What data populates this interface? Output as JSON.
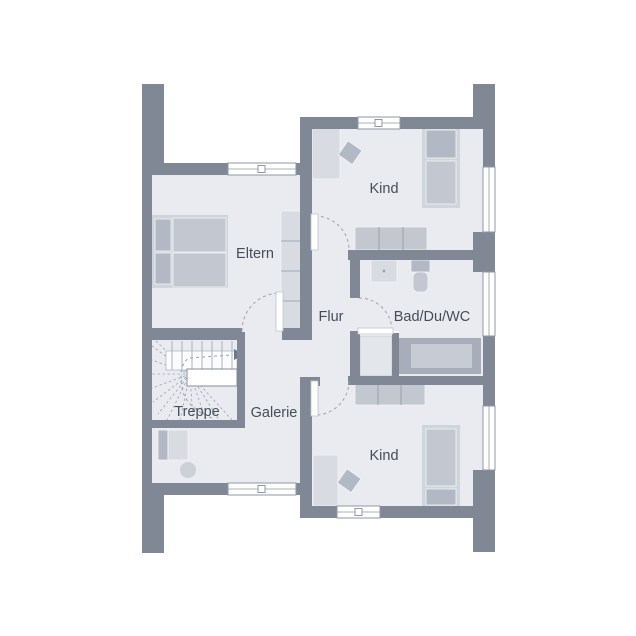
{
  "rooms": {
    "eltern": "Eltern",
    "kind_top": "Kind",
    "bad": "Bad/Du/WC",
    "flur": "Flur",
    "treppe": "Treppe",
    "galerie": "Galerie",
    "kind_bottom": "Kind"
  },
  "colors": {
    "wall": "#808896",
    "floor": "#e9ebf0",
    "background": "#ffffff",
    "furniture_light": "#d8dce2",
    "furniture_mid": "#c2c7d0",
    "furniture_dark": "#b3b9c4",
    "furniture_frame": "#d0d4db",
    "tub_outer": "#a7aeb9",
    "tub_inner": "#c7cbd3",
    "outline": "#9aa3af",
    "window_frame": "#8f97a4",
    "text": "#464d59",
    "door_leaf": "#ffffff"
  }
}
